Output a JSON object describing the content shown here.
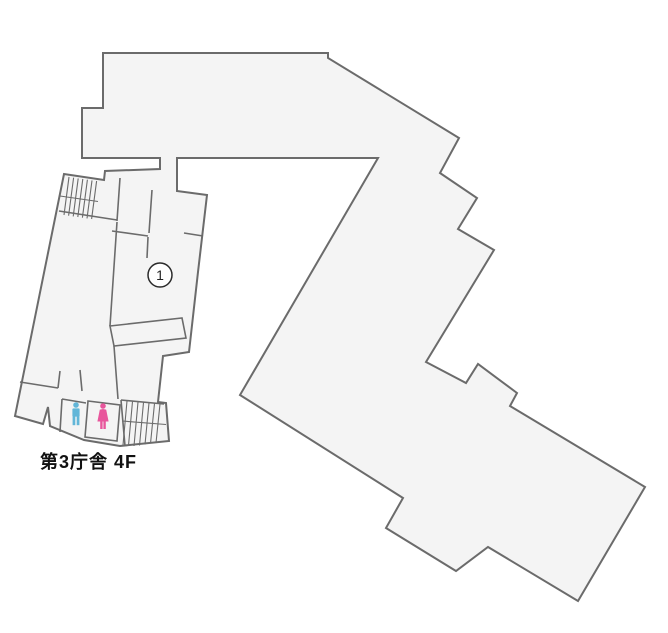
{
  "floor_label": "第3庁舎 4F",
  "marker": {
    "label": "1"
  },
  "legend": {
    "male_restroom": "men-restroom",
    "female_restroom": "women-restroom",
    "stairs_upper": "stairs",
    "stairs_lower": "stairs"
  },
  "colors": {
    "building_fill": "#f4f4f4",
    "building_stroke": "#6b6b6b",
    "male_icon": "#62b6d8",
    "female_icon": "#e8569c",
    "marker_stroke": "#2b2b2b",
    "label_color": "#111111",
    "background": "#ffffff"
  }
}
